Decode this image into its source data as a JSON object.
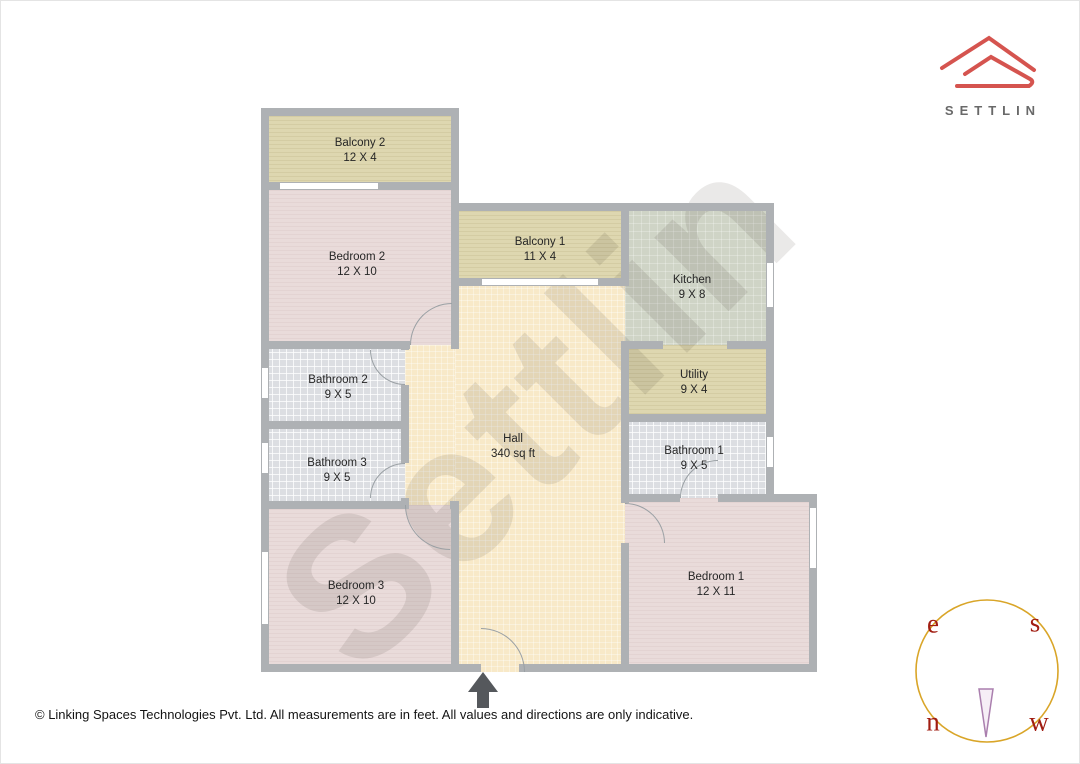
{
  "watermark_text": "Settlin",
  "logo": {
    "text": "SETTLIN"
  },
  "footer_text": "© Linking Spaces Technologies Pvt. Ltd. All measurements are in feet. All values and directions are only indicative.",
  "compass": {
    "east": "e",
    "south": "s",
    "north": "n",
    "west": "w"
  },
  "rooms": [
    {
      "id": "balcony-2",
      "name": "Balcony 2",
      "dims": "12 X 4",
      "floor": "balcony",
      "color": "#ded7b0"
    },
    {
      "id": "bedroom-2",
      "name": "Bedroom 2",
      "dims": "12 X 10",
      "floor": "bedroom",
      "color": "#e9dbda"
    },
    {
      "id": "balcony-1",
      "name": "Balcony 1",
      "dims": "11 X 4",
      "floor": "balcony",
      "color": "#ded7b0"
    },
    {
      "id": "kitchen",
      "name": "Kitchen",
      "dims": "9 X 8",
      "floor": "kitchen",
      "color": "#cfd4c6"
    },
    {
      "id": "bathroom-2",
      "name": "Bathroom 2",
      "dims": "9 X 5",
      "floor": "tile",
      "color": "#dcdee2"
    },
    {
      "id": "bathroom-3",
      "name": "Bathroom 3",
      "dims": "9 X 5",
      "floor": "tile",
      "color": "#dcdee2"
    },
    {
      "id": "utility",
      "name": "Utility",
      "dims": "9 X 4",
      "floor": "balcony",
      "color": "#ded7b0"
    },
    {
      "id": "bathroom-1",
      "name": "Bathroom 1",
      "dims": "9 X 5",
      "floor": "tile",
      "color": "#dcdee2"
    },
    {
      "id": "hall",
      "name": "Hall",
      "dims": "340 sq ft",
      "floor": "hall",
      "color": "#f8e9c8"
    },
    {
      "id": "bedroom-3",
      "name": "Bedroom 3",
      "dims": "12 X 10",
      "floor": "bedroom",
      "color": "#e9dbda"
    },
    {
      "id": "bedroom-1",
      "name": "Bedroom 1",
      "dims": "12 X 11",
      "floor": "bedroom",
      "color": "#e9dbda"
    }
  ],
  "palette": {
    "brand_red": "#d5544f",
    "brand_text_gray": "#696969",
    "wall_gray": "#aeb1b4",
    "compass_ring_gold": "#d9a528",
    "compass_letter_red": "#a11d12",
    "compass_needle_purple": "#aa7fae",
    "entrance_arrow_gray": "#55585c"
  }
}
